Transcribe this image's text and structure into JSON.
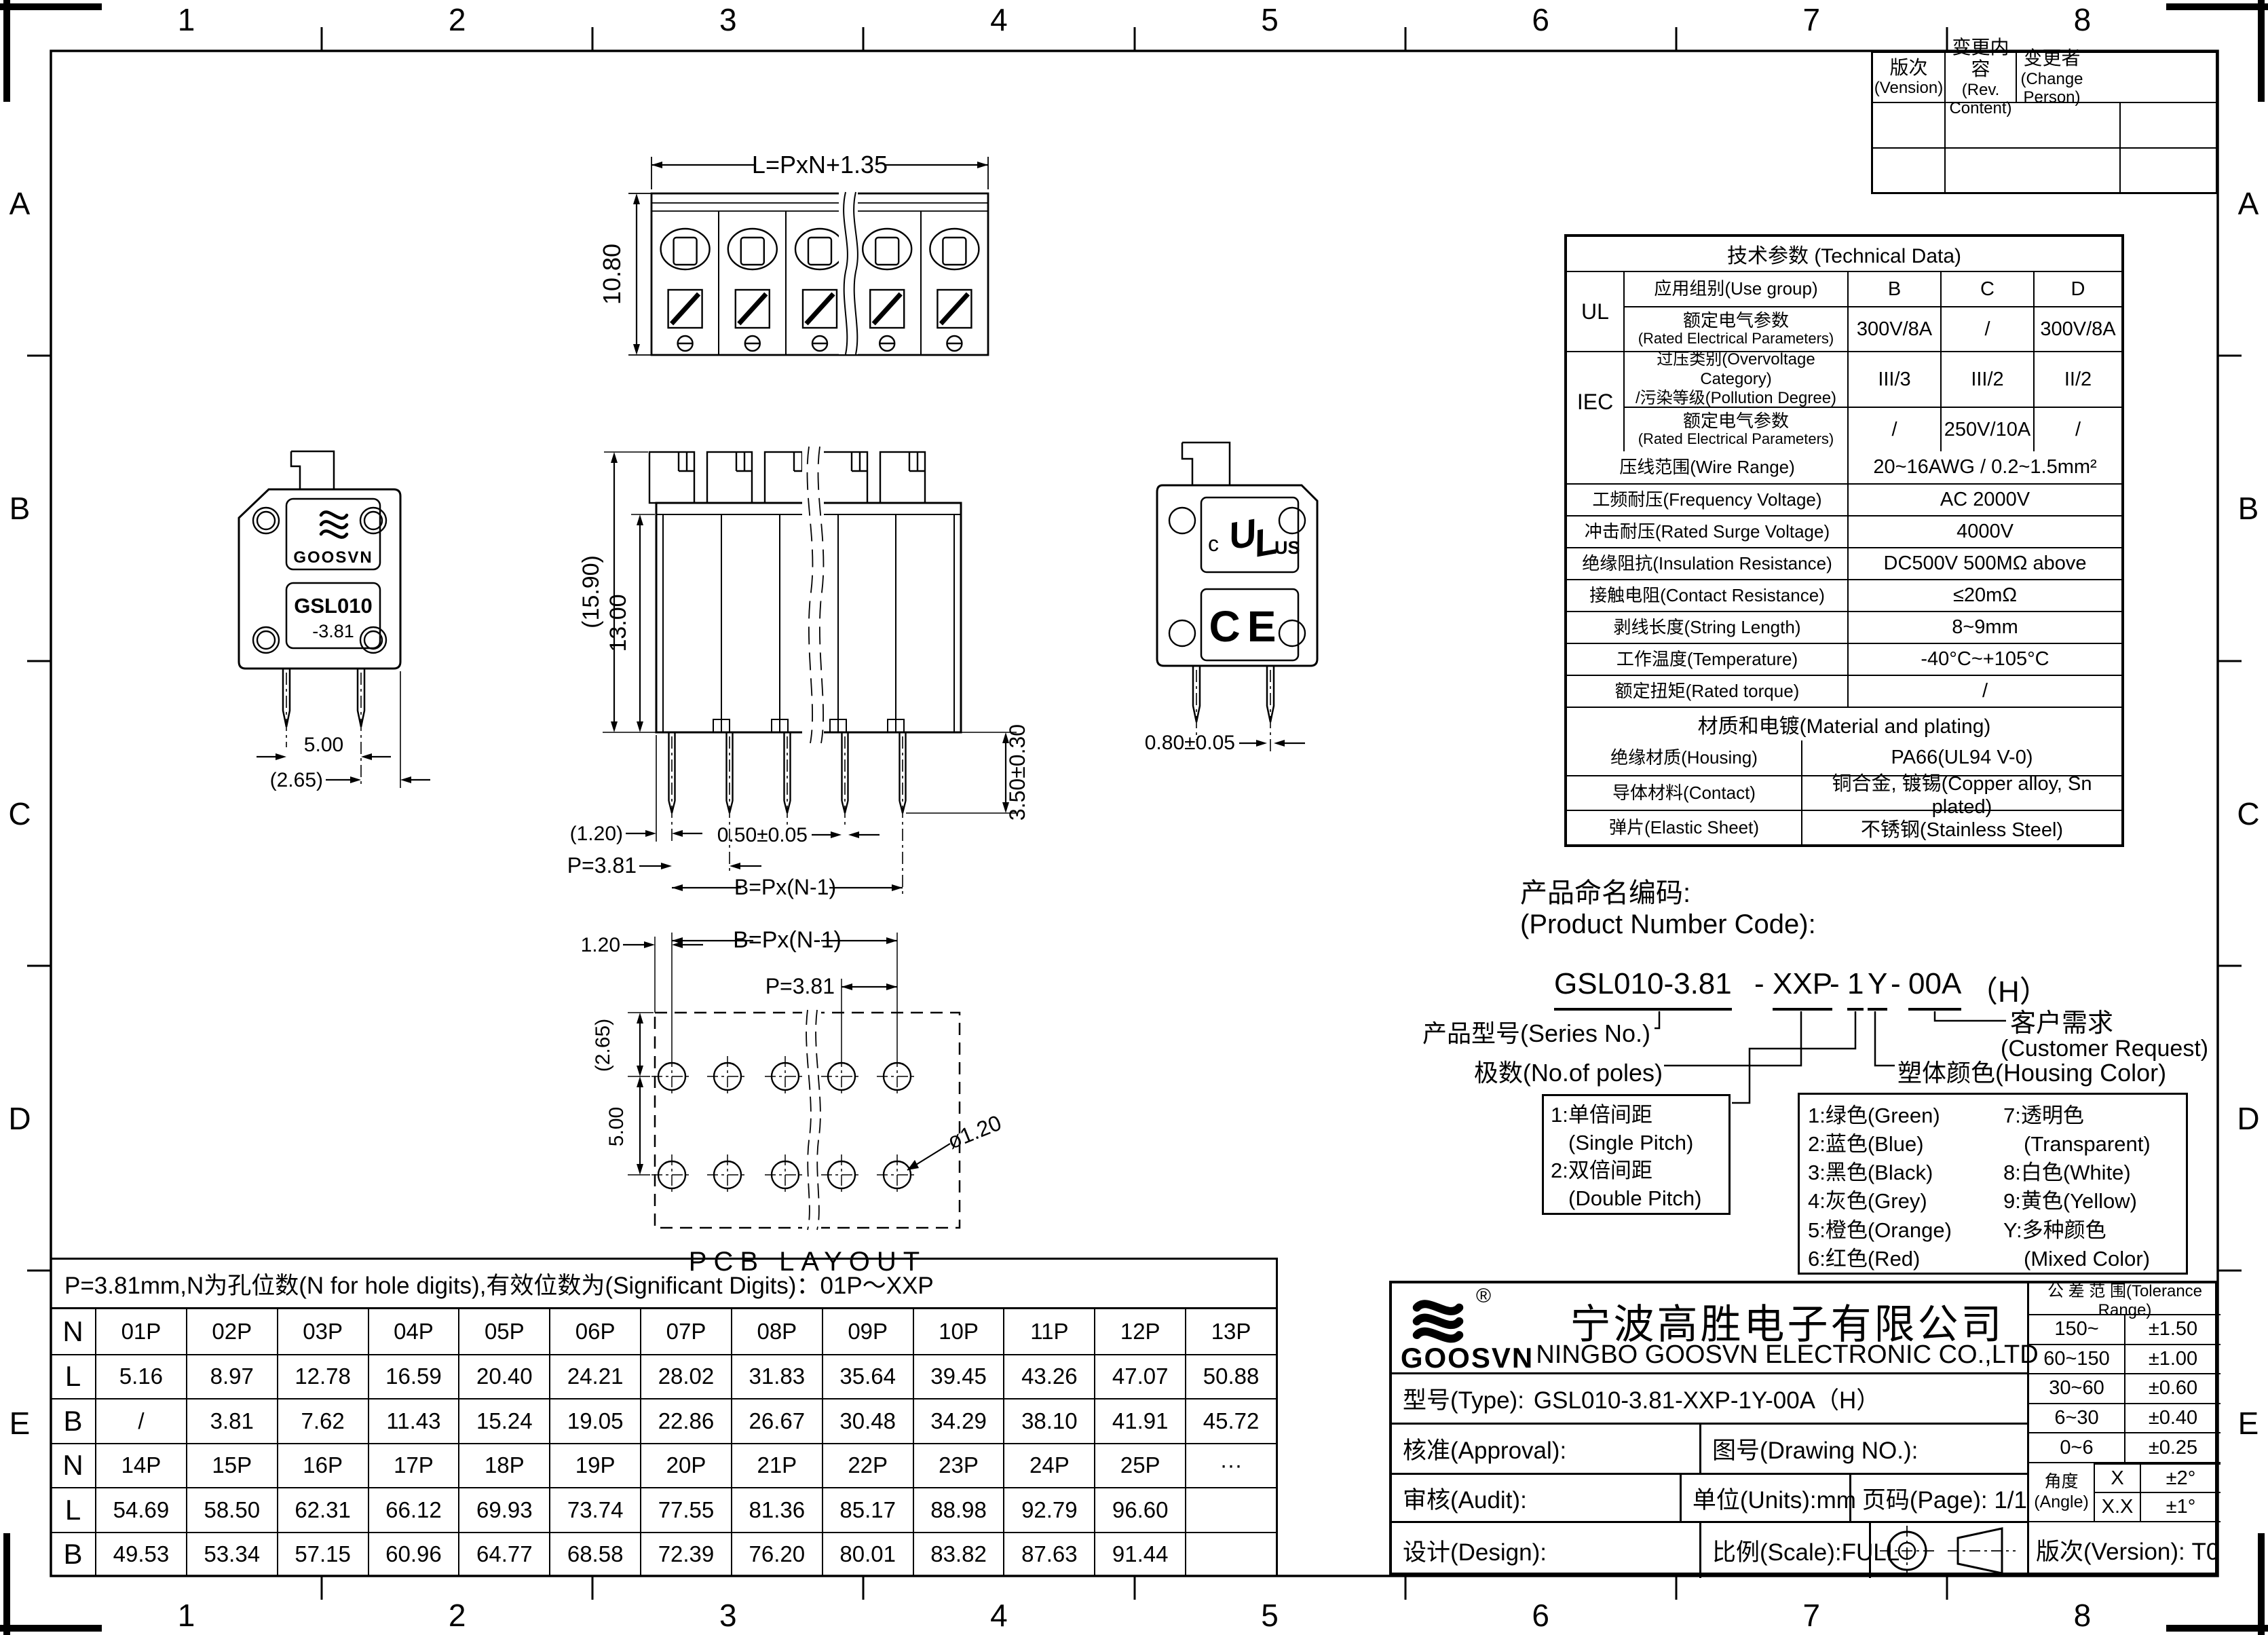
{
  "frame": {
    "columns": [
      "1",
      "2",
      "3",
      "4",
      "5",
      "6",
      "7",
      "8"
    ],
    "rows": [
      "A",
      "B",
      "C",
      "D",
      "E"
    ]
  },
  "revision_table": {
    "headers": [
      {
        "cn": "版次",
        "en": "(Vension)"
      },
      {
        "cn": "变更内容",
        "en": "(Rev. Content)"
      },
      {
        "cn": "变更者",
        "en": "(Change Person)"
      }
    ]
  },
  "tech": {
    "title": "技术参数 (Technical Data)",
    "ul": "UL",
    "iec": "IEC",
    "use_group": {
      "label": "应用组别(Use group)",
      "b": "B",
      "c": "C",
      "d": "D"
    },
    "ul_rated": {
      "cn": "额定电气参数",
      "en": "(Rated Electrical Parameters)",
      "b": "300V/8A",
      "c": "/",
      "d": "300V/8A"
    },
    "overvoltage": {
      "cn": "过压类别(Overvoltage Category)",
      "en": "/污染等级(Pollution Degree)",
      "b": "III/3",
      "c": "III/2",
      "d": "II/2"
    },
    "iec_rated": {
      "cn": "额定电气参数",
      "en": "(Rated Electrical Parameters)",
      "b": "/",
      "c": "250V/10A",
      "d": "/"
    },
    "simple_rows": [
      {
        "label": "压线范围(Wire Range)",
        "value": "20~16AWG / 0.2~1.5mm²"
      },
      {
        "label": "工频耐压(Frequency Voltage)",
        "value": "AC 2000V"
      },
      {
        "label": "冲击耐压(Rated Surge Voltage)",
        "value": "4000V"
      },
      {
        "label": "绝缘阻抗(Insulation Resistance)",
        "value": "DC500V 500MΩ above"
      },
      {
        "label": "接触电阻(Contact Resistance)",
        "value": "≤20mΩ"
      },
      {
        "label": "剥线长度(String Length)",
        "value": "8~9mm"
      },
      {
        "label": "工作温度(Temperature)",
        "value": "-40°C~+105°C"
      },
      {
        "label": "额定扭矩(Rated torque)",
        "value": "/"
      }
    ],
    "material_title": "材质和电镀(Material and plating)",
    "material_rows": [
      {
        "label": "绝缘材质(Housing)",
        "value": "PA66(UL94 V-0)"
      },
      {
        "label": "导体材料(Contact)",
        "value": "铜合金, 镀锡(Copper alloy, Sn plated)"
      },
      {
        "label": "弹片(Elastic Sheet)",
        "value": "不锈钢(Stainless Steel)"
      }
    ]
  },
  "code_section": {
    "title_cn": "产品命名编码:",
    "title_en": "(Product Number Code):",
    "segments": {
      "s1": "GSL010-3.81",
      "d1": "-",
      "s2": "XXP",
      "d2": "-",
      "s3": "1",
      "s4": "Y",
      "d3": "-",
      "s5": "00A",
      "s6": "（H）"
    },
    "series_label": "产品型号(Series No.)",
    "poles_label": "极数(No.of poles)",
    "customer_cn": "客户需求",
    "customer_en": "(Customer Request)",
    "color_label": "塑体颜色(Housing Color)",
    "pitch_box": [
      "1:单倍间距",
      "(Single Pitch)",
      "2:双倍间距",
      "(Double Pitch)"
    ],
    "color_box_left": [
      "1:绿色(Green)",
      "2:蓝色(Blue)",
      "3:黑色(Black)",
      "4:灰色(Grey)",
      "5:橙色(Orange)",
      "6:红色(Red)"
    ],
    "color_box_right": [
      "7:透明色",
      "(Transparent)",
      "8:白色(White)",
      "9:黄色(Yellow)",
      "Y:多种颜色",
      "(Mixed Color)"
    ]
  },
  "dim_table": {
    "note": "P=3.81mm,N为孔位数(N for hole digits),有效位数为(Significant Digits)：01P～XXP",
    "rows": [
      [
        "N",
        "01P",
        "02P",
        "03P",
        "04P",
        "05P",
        "06P",
        "07P",
        "08P",
        "09P",
        "10P",
        "11P",
        "12P",
        "13P"
      ],
      [
        "L",
        "5.16",
        "8.97",
        "12.78",
        "16.59",
        "20.40",
        "24.21",
        "28.02",
        "31.83",
        "35.64",
        "39.45",
        "43.26",
        "47.07",
        "50.88"
      ],
      [
        "B",
        "/",
        "3.81",
        "7.62",
        "11.43",
        "15.24",
        "19.05",
        "22.86",
        "26.67",
        "30.48",
        "34.29",
        "38.10",
        "41.91",
        "45.72"
      ],
      [
        "N",
        "14P",
        "15P",
        "16P",
        "17P",
        "18P",
        "19P",
        "20P",
        "21P",
        "22P",
        "23P",
        "24P",
        "25P",
        "···"
      ],
      [
        "L",
        "54.69",
        "58.50",
        "62.31",
        "66.12",
        "69.93",
        "73.74",
        "77.55",
        "81.36",
        "85.17",
        "88.98",
        "92.79",
        "96.60",
        ""
      ],
      [
        "B",
        "49.53",
        "53.34",
        "57.15",
        "60.96",
        "64.77",
        "68.58",
        "72.39",
        "76.20",
        "80.01",
        "83.82",
        "87.63",
        "91.44",
        ""
      ]
    ]
  },
  "title_block": {
    "brand": "GOOSVN",
    "registered": "®",
    "company_cn": "宁波高胜电子有限公司",
    "company_en": "NINGBO GOOSVN ELECTRONIC CO.,LTD",
    "type_label": "型号(Type):",
    "type_value": "GSL010-3.81-XXP-1Y-00A（H）",
    "approval": "核准(Approval):",
    "drawing_no": "图号(Drawing NO.):",
    "audit": "审核(Audit):",
    "units": "单位(Units):mm",
    "page": "页码(Page): 1/1",
    "design": "设计(Design):",
    "scale": "比例(Scale):FULL",
    "version": "版次(Version): T0",
    "tolerance": {
      "title": "公 差 范 围(Tolerance Range)",
      "rows": [
        [
          "150~",
          "±1.50"
        ],
        [
          "60~150",
          "±1.00"
        ],
        [
          "30~60",
          "±0.60"
        ],
        [
          "6~30",
          "±0.40"
        ],
        [
          "0~6",
          "±0.25"
        ]
      ],
      "angle_cn": "角度",
      "angle_en": "(Angle)",
      "angle_rows": [
        [
          "X",
          "±2°"
        ],
        [
          "X.X",
          "±1°"
        ]
      ]
    }
  },
  "views": {
    "top": {
      "dim_length": "L=PxN+1.35",
      "dim_height": "10.80"
    },
    "side_left": {
      "brand": "GOOSVN",
      "model": "GSL010",
      "pitch": "-3.81",
      "dim_pin_span": "5.00",
      "dim_edge": "(2.65)"
    },
    "front": {
      "dim_total": "(15.90)",
      "dim_body": "13.00",
      "dim_pin_len": "3.50±0.30",
      "dim_end": "(1.20)",
      "dim_pin_w": "0.50±0.05",
      "dim_pitch": "P=3.81",
      "dim_span": "B=Px(N-1)"
    },
    "side_right": {
      "ul_c": "c",
      "ul_u": "U",
      "ul_l": "L",
      "ul_us": "US",
      "ce": "CE",
      "dim_pin_t": "0.80±0.05"
    },
    "pcb": {
      "dim_offset": "1.20",
      "dim_span": "B=Px(N-1)",
      "dim_pitch": "P=3.81",
      "dim_row1": "(2.65)",
      "dim_rows": "5.00",
      "dim_hole": "ø1.20",
      "caption": "PCB LAYOUT"
    }
  }
}
